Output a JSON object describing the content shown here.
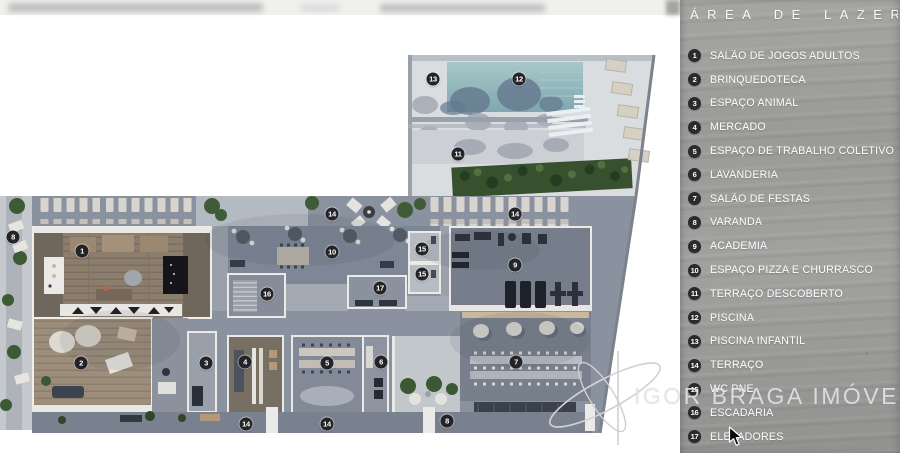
{
  "legend": {
    "title": "ÁREA DE LAZER",
    "items": [
      {
        "number": "1",
        "label": "SALÃO DE JOGOS ADULTOS"
      },
      {
        "number": "2",
        "label": "BRINQUEDOTECA"
      },
      {
        "number": "3",
        "label": "ESPAÇO ANIMAL"
      },
      {
        "number": "4",
        "label": "MERCADO"
      },
      {
        "number": "5",
        "label": "ESPAÇO DE TRABALHO COLETIVO"
      },
      {
        "number": "6",
        "label": "LAVANDERIA"
      },
      {
        "number": "7",
        "label": "SALÃO DE FESTAS"
      },
      {
        "number": "8",
        "label": "VARANDA"
      },
      {
        "number": "9",
        "label": "ACADEMIA"
      },
      {
        "number": "10",
        "label": "ESPAÇO PIZZA E CHURRASCO"
      },
      {
        "number": "11",
        "label": "TERRAÇO DESCOBERTO"
      },
      {
        "number": "12",
        "label": "PISCINA"
      },
      {
        "number": "13",
        "label": "PISCINA INFANTIL"
      },
      {
        "number": "14",
        "label": "TERRAÇO"
      },
      {
        "number": "15",
        "label": "WC PNE"
      },
      {
        "number": "16",
        "label": "ESCADARIA"
      },
      {
        "number": "17",
        "label": "ELEVADORES"
      }
    ]
  },
  "watermark": {
    "text": "IGOR BRAGA IMÓVEIS"
  },
  "floorplan": {
    "markers": [
      {
        "number": "8",
        "x": 13,
        "y": 237
      },
      {
        "number": "1",
        "x": 82,
        "y": 251
      },
      {
        "number": "14",
        "x": 332,
        "y": 214
      },
      {
        "number": "14",
        "x": 515,
        "y": 214
      },
      {
        "number": "10",
        "x": 332,
        "y": 252
      },
      {
        "number": "16",
        "x": 267,
        "y": 294
      },
      {
        "number": "17",
        "x": 380,
        "y": 288
      },
      {
        "number": "15",
        "x": 422,
        "y": 249
      },
      {
        "number": "15",
        "x": 422,
        "y": 274
      },
      {
        "number": "9",
        "x": 515,
        "y": 265
      },
      {
        "number": "2",
        "x": 81,
        "y": 363
      },
      {
        "number": "3",
        "x": 206,
        "y": 363
      },
      {
        "number": "4",
        "x": 245,
        "y": 362
      },
      {
        "number": "5",
        "x": 327,
        "y": 363
      },
      {
        "number": "6",
        "x": 381,
        "y": 362
      },
      {
        "number": "7",
        "x": 516,
        "y": 362
      },
      {
        "number": "11",
        "x": 458,
        "y": 154
      },
      {
        "number": "12",
        "x": 519,
        "y": 79
      },
      {
        "number": "13",
        "x": 433,
        "y": 79
      },
      {
        "number": "14",
        "x": 246,
        "y": 424
      },
      {
        "number": "14",
        "x": 327,
        "y": 424
      },
      {
        "number": "8",
        "x": 447,
        "y": 421
      }
    ]
  },
  "colors": {
    "pool": "#8fb4ba",
    "panel_concrete": "#9a9a98",
    "badge": "#2b2b2d",
    "legend_text": "#ffffff",
    "terrace_floor": "#8a92a0"
  }
}
